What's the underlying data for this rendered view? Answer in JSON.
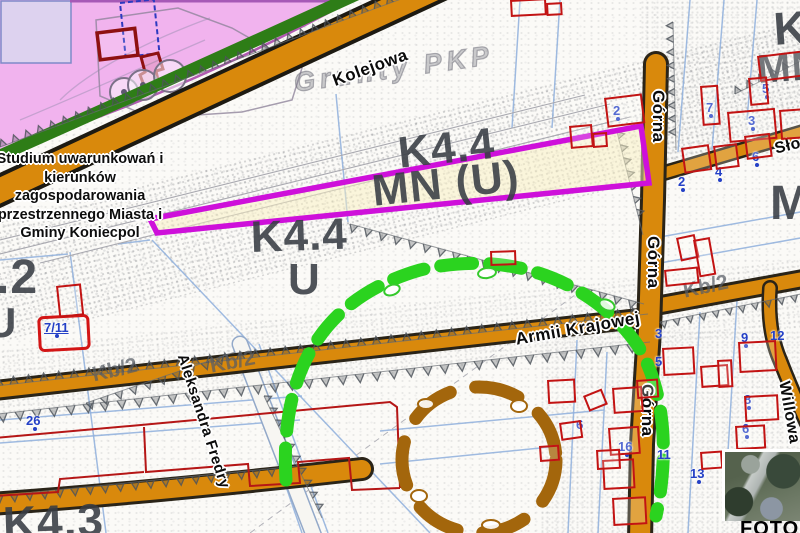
{
  "map": {
    "attribution_lines": [
      "Studium uwarunkowań i",
      "kierunków",
      "zagospodarowania",
      "przestrzennego Miasta i",
      "Gminy Koniecpol"
    ],
    "base_label": "Grunty PKP",
    "photo_label": "FOTO",
    "streets": [
      {
        "id": "kolejowa",
        "name": "Kolejowa",
        "x": 330,
        "y": 72,
        "rot": -20,
        "size": 17
      },
      {
        "id": "armii-krajowej",
        "name": "Armii Krajowej",
        "x": 514,
        "y": 330,
        "rot": -10,
        "size": 17
      },
      {
        "id": "gorna-top",
        "name": "Górna",
        "x": 668,
        "y": 90,
        "rot": 90,
        "size": 17
      },
      {
        "id": "gorna-mid",
        "name": "Górna",
        "x": 663,
        "y": 236,
        "rot": 90,
        "size": 17
      },
      {
        "id": "gorna-bottom",
        "name": "Górna",
        "x": 657,
        "y": 384,
        "rot": 90,
        "size": 17
      },
      {
        "id": "aleksandra-fredry",
        "name": "Aleksandra Fredry",
        "x": 190,
        "y": 352,
        "rot": 72,
        "size": 15
      },
      {
        "id": "slowackiego",
        "name": "Słowackiego",
        "x": 773,
        "y": 141,
        "rot": -14,
        "size": 16
      },
      {
        "id": "willowa",
        "name": "Willowa",
        "x": 792,
        "y": 380,
        "rot": 80,
        "size": 16
      }
    ],
    "zone_labels": [
      {
        "text": "K4.4",
        "x": 396,
        "y": 132,
        "size": 44,
        "rot": -6
      },
      {
        "text": "MN (U)",
        "x": 370,
        "y": 170,
        "size": 44,
        "rot": -6
      },
      {
        "text": "K4.4",
        "x": 250,
        "y": 216,
        "size": 44,
        "rot": -2
      },
      {
        "text": "U",
        "x": 288,
        "y": 258,
        "size": 44,
        "rot": 0
      },
      {
        "text": ".2",
        "x": -4,
        "y": 254,
        "size": 48,
        "rot": 0
      },
      {
        "text": "U",
        "x": -14,
        "y": 302,
        "size": 42,
        "rot": 0
      },
      {
        "text": "K4.3",
        "x": 2,
        "y": 500,
        "size": 46,
        "rot": -2
      },
      {
        "text": "K",
        "x": 772,
        "y": 6,
        "size": 46,
        "rot": -4
      },
      {
        "text": "MN",
        "x": 756,
        "y": 50,
        "size": 40,
        "rot": -4
      },
      {
        "text": "M",
        "x": 770,
        "y": 180,
        "size": 48,
        "rot": 0
      }
    ],
    "road_class_labels": [
      {
        "text": "Kb/2",
        "x": 90,
        "y": 364,
        "rot": -13
      },
      {
        "text": "Kb/2",
        "x": 208,
        "y": 355,
        "rot": -11
      },
      {
        "text": "Kb/2",
        "x": 681,
        "y": 280,
        "rot": -12
      }
    ],
    "parcel_numbers": [
      {
        "text": "7/11",
        "x": 44,
        "y": 320,
        "u": true,
        "d": 1
      },
      {
        "text": "26",
        "x": 26,
        "y": 413,
        "d": 1
      },
      {
        "text": "2",
        "x": 613,
        "y": 103,
        "d": 1
      },
      {
        "text": "5",
        "x": 762,
        "y": 81,
        "d": 1
      },
      {
        "text": "7",
        "x": 706,
        "y": 100,
        "d": 1
      },
      {
        "text": "3",
        "x": 748,
        "y": 113,
        "d": 1
      },
      {
        "text": "6",
        "x": 752,
        "y": 149,
        "d": 1
      },
      {
        "text": "4",
        "x": 715,
        "y": 164,
        "d": 1
      },
      {
        "text": "2",
        "x": 678,
        "y": 174,
        "d": 1
      },
      {
        "text": "9",
        "x": 741,
        "y": 330,
        "d": 1
      },
      {
        "text": "3",
        "x": 655,
        "y": 326,
        "d": 0
      },
      {
        "text": "5",
        "x": 655,
        "y": 354,
        "d": 0
      },
      {
        "text": "12",
        "x": 770,
        "y": 328,
        "d": 0
      },
      {
        "text": "8",
        "x": 744,
        "y": 392,
        "d": 1
      },
      {
        "text": "6",
        "x": 742,
        "y": 421,
        "d": 1
      },
      {
        "text": "16",
        "x": 618,
        "y": 439,
        "d": 1
      },
      {
        "text": "11",
        "x": 657,
        "y": 447,
        "d": 0
      },
      {
        "text": "13",
        "x": 690,
        "y": 466,
        "d": 1
      },
      {
        "text": "6",
        "x": 576,
        "y": 417,
        "d": 0
      }
    ],
    "colors": {
      "road_fill": "#d9890c",
      "road_border": "#2a2418",
      "industrial_pink": "#f1b3ee",
      "green_belt": "#2e7d17",
      "highlight_magenta": "#ce10da",
      "highlight_inner_yellow": "#faf0c0",
      "dashed_circle_green": "#2bd31f",
      "dashed_circle_brown": "#a3660c",
      "building_red": "#c21313",
      "parcel_number_blue": "#2440c6",
      "zone_text_grey": "#383d44"
    }
  }
}
